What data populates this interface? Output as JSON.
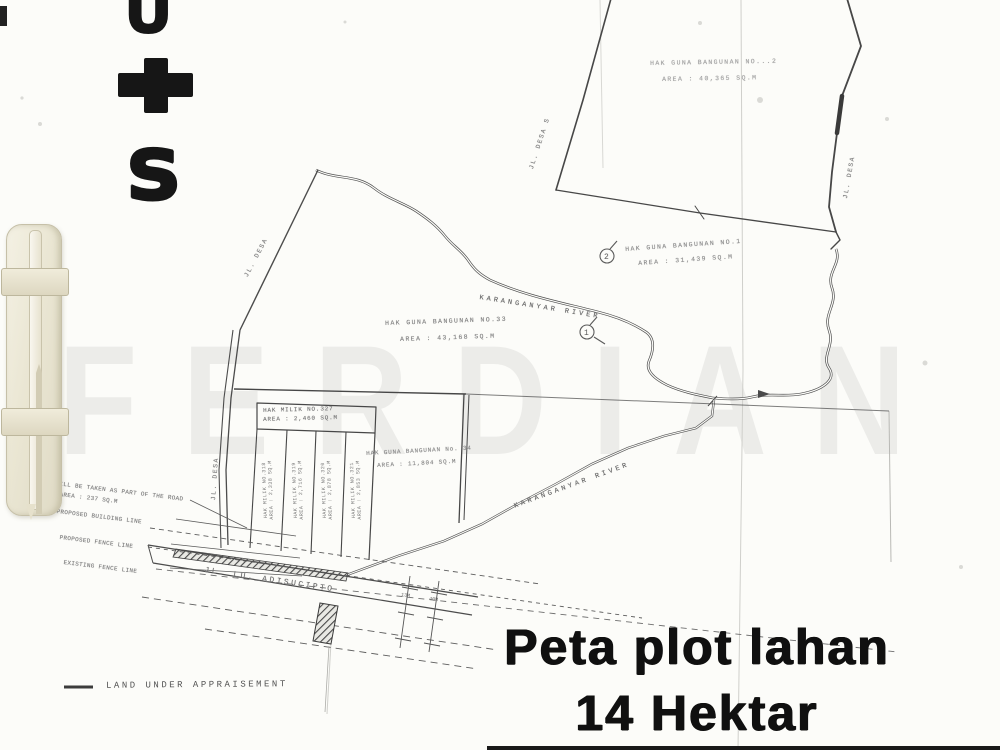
{
  "stamp": {
    "letters": [
      "U",
      "+",
      "s"
    ]
  },
  "watermark": {
    "text": "FERDIAN"
  },
  "title": {
    "line1": "Peta plot lahan",
    "line2": "14 Hektar"
  },
  "legend": {
    "label": "LAND UNDER APPRAISEMENT"
  },
  "river": {
    "name": "KARANGANYAR RIVER"
  },
  "roads": {
    "adisucipto": "JL. LU. ADISUCIPTO",
    "desa": [
      "JL. DESA",
      "JL. DESA S",
      "JL. DESA",
      "JL. DESA"
    ]
  },
  "markers": {
    "one": "1",
    "two": "2"
  },
  "parcels": {
    "hgb_top": {
      "line1": "HAK GUNA BANGUNAN NO...2",
      "line2": "AREA : 40,365 SQ.M"
    },
    "hgb_1": {
      "line1": "HAK GUNA BANGUNAN NO.1",
      "line2": "AREA : 31,439 SQ.M"
    },
    "hgb_33": {
      "line1": "HAK GUNA BANGUNAN NO.33",
      "line2": "AREA : 43,168 SQ.M"
    },
    "hgb_34": {
      "line1": "HAK GUNA BANGUNAN No. 34",
      "line2": "AREA : 11,804 SQ.M"
    },
    "hm_327": {
      "line1": "HAK MILIK NO.327",
      "line2": "AREA : 2,460 SQ.M"
    },
    "strips": [
      {
        "line1": "HAK MILIK NO.318",
        "line2": "AREA : 2,338 SQ.M"
      },
      {
        "line1": "HAK MILIK NO.319",
        "line2": "AREA : 2,716 SQ.M"
      },
      {
        "line1": "HAK MILIK NO.320",
        "line2": "AREA : 2,878 SQ.M"
      },
      {
        "line1": "HAK MILIK NO.321",
        "line2": "AREA : 2,853 SQ.M"
      }
    ]
  },
  "annotations": {
    "road_take_line1": "WILL BE TAKEN AS PART OF THE ROAD",
    "road_take_line2": "AREA : 237 SQ.M",
    "building_line": "PROPOSED BUILDING LINE",
    "fence_line": "PROPOSED FENCE LINE",
    "existing_fence": "EXISTING FENCE LINE",
    "dims": [
      "13M",
      "40M"
    ]
  }
}
